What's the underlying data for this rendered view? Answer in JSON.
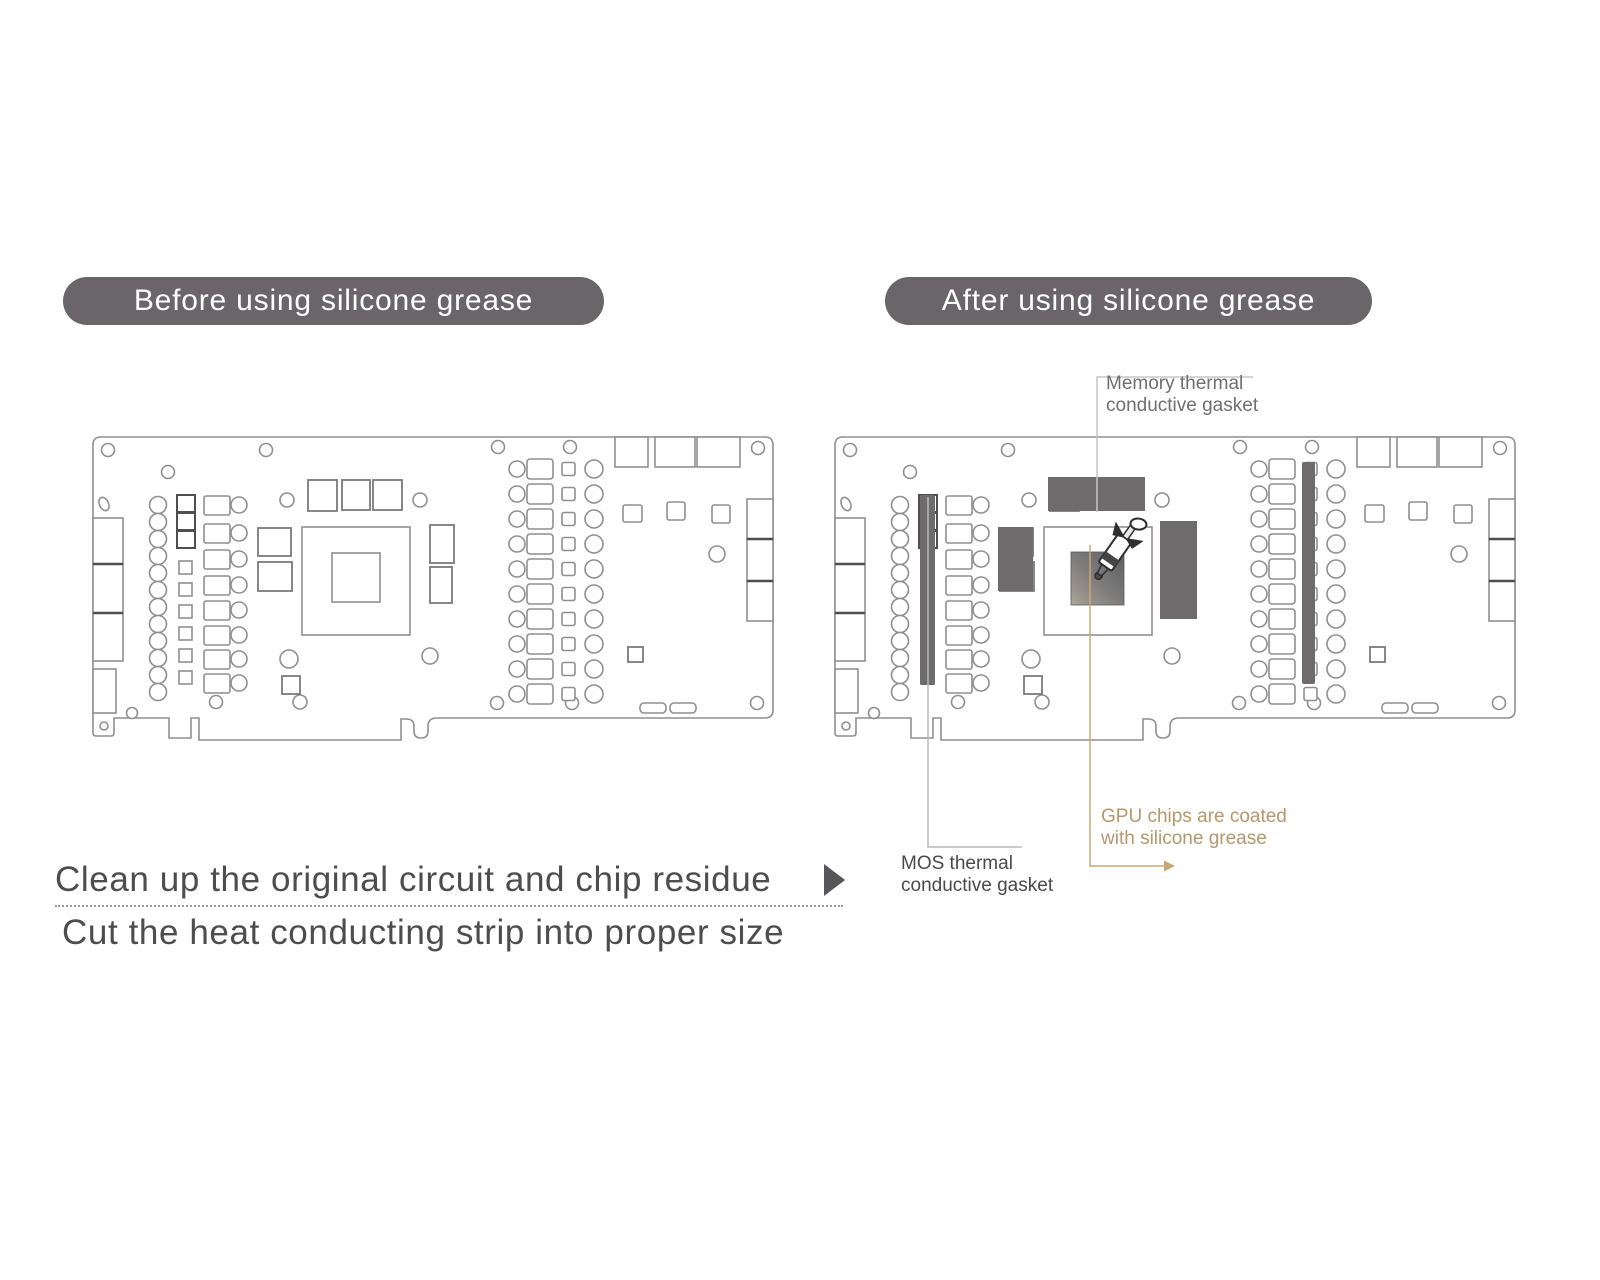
{
  "titles": {
    "before": "Before using silicone grease",
    "after": "After using silicone grease"
  },
  "annotations": {
    "memory": {
      "line1": "Memory thermal",
      "line2": "conductive gasket"
    },
    "mos": {
      "line1": "MOS thermal",
      "line2": "conductive gasket"
    },
    "gpu": {
      "line1": "GPU chips are coated",
      "line2": "with silicone grease"
    }
  },
  "steps": {
    "step1": "Clean up the original circuit and chip residue",
    "step2": "Cut the heat conducting strip into proper size"
  },
  "icons": {
    "step_arrow": "right-triangle-arrow",
    "syringe": "silicone-grease-syringe"
  },
  "colors": {
    "pill_bg": "#696568",
    "pill_text": "#ffffff",
    "board_line": "#8f8f8f",
    "dark_component": "#6e6b6d",
    "tan_accent": "#b5986b",
    "step_text": "#4d4d4d",
    "memory_label": "#6f6f6f",
    "mos_label": "#4a4a4a",
    "callout_gray": "#bdbdbd"
  }
}
